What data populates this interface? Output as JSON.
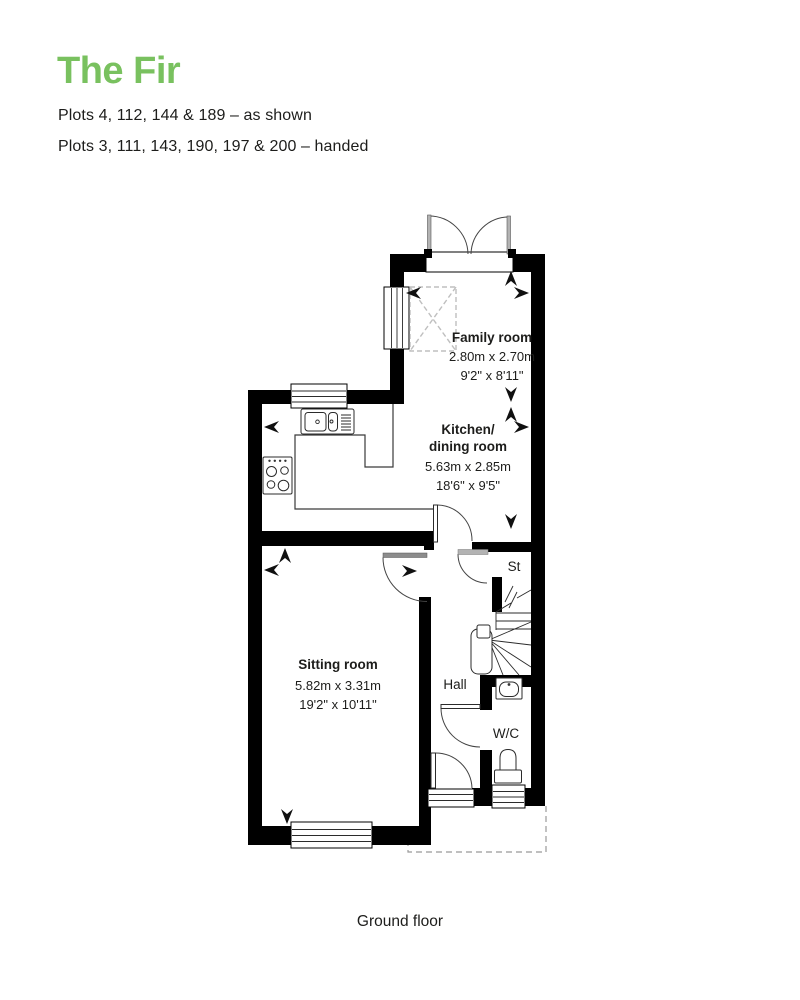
{
  "header": {
    "title": "The Fir",
    "plots_line1": "Plots 4, 112, 144 & 189 – as shown",
    "plots_line2": "Plots 3, 111, 143, 190, 197 & 200 – handed"
  },
  "floor_label": "Ground floor",
  "rooms": {
    "family": {
      "name": "Family room",
      "metric": "2.80m x 2.70m",
      "imperial": "9'2\" x 8'11\""
    },
    "kitchen": {
      "name_line1": "Kitchen/",
      "name_line2": "dining room",
      "metric": "5.63m x 2.85m",
      "imperial": "18'6\" x 9'5\""
    },
    "sitting": {
      "name": "Sitting room",
      "metric": "5.82m x 3.31m",
      "imperial": "19'2\" x 10'11\""
    },
    "hall": {
      "name": "Hall"
    },
    "store": {
      "name": "St"
    },
    "wc": {
      "name": "W/C"
    }
  },
  "colors": {
    "accent_green": "#79c15f",
    "text": "#1d1d1b",
    "wall": "#000000"
  }
}
